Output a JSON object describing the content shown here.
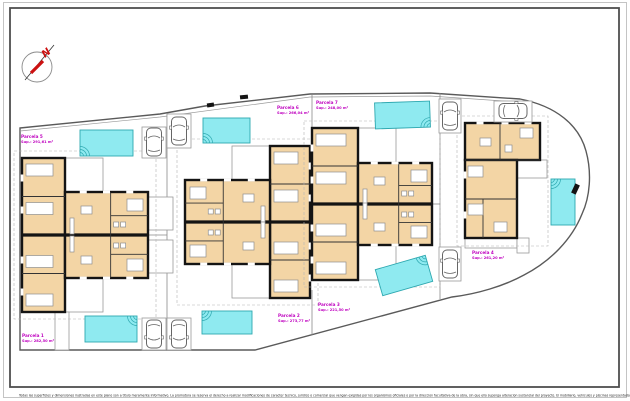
{
  "document": {
    "type": "architectural-site-plan"
  },
  "colors": {
    "room": "#f3d5a5",
    "wall": "#141414",
    "pool_fill": "#8feaf0",
    "pool_edge": "#2ea8b0",
    "label": "#bf00bf",
    "north_red": "#cc1111",
    "boundary": "#5a5a5a",
    "thin_line": "#8a8a8a",
    "frame_outer": "#c4c4c4",
    "frame_inner": "#4f4f4f",
    "furniture": "#8f8f8f"
  },
  "north": {
    "label": "N"
  },
  "parcels": [
    {
      "id": 1,
      "name": "Parcela 1",
      "sup": "Sup.: 282,50 m²",
      "label_x": 22,
      "label_y": 333
    },
    {
      "id": 2,
      "name": "Parcela 2",
      "sup": "Sup.: 273,77 m²",
      "label_x": 278,
      "label_y": 313
    },
    {
      "id": 3,
      "name": "Parcela 3",
      "sup": "Sup.: 221,50 m²",
      "label_x": 318,
      "label_y": 302
    },
    {
      "id": 4,
      "name": "Parcela 4",
      "sup": "Sup.: 261,20 m²",
      "label_x": 472,
      "label_y": 250
    },
    {
      "id": 5,
      "name": "Parcela 5",
      "sup": "Sup.: 291,61 m²",
      "label_x": 21,
      "label_y": 134
    },
    {
      "id": 6,
      "name": "Parcela 6",
      "sup": "Sup.: 266,04 m²",
      "label_x": 277,
      "label_y": 105
    },
    {
      "id": 7,
      "name": "Parcela 7",
      "sup": "Sup.: 248,00 m²",
      "label_x": 316,
      "label_y": 100
    }
  ],
  "site": {
    "boundary": "M20,128 L160,114 L205,106 L310,94 L430,93 L520,99 C556,106 579,125 586,151 C592,173 590,197 582,214 C572,239 551,261 524,275 C504,286 477,294 452,297 L255,350 L20,350 Z",
    "boundary_inner": "M20,131 L160,117 L310,97 L430,96 L518,102",
    "division_lines": [
      [
        167,
        113,
        167,
        350
      ],
      [
        312,
        95,
        312,
        160
      ],
      [
        312,
        290,
        312,
        335
      ],
      [
        440,
        93,
        440,
        299
      ],
      [
        148,
        235,
        167,
        235
      ],
      [
        432,
        204,
        440,
        204
      ],
      [
        310,
        222,
        312,
        222
      ]
    ],
    "terraces": [
      [
        65,
        158,
        38,
        34
      ],
      [
        65,
        278,
        38,
        34
      ],
      [
        148,
        197,
        25,
        33
      ],
      [
        148,
        240,
        25,
        33
      ],
      [
        232,
        146,
        38,
        34
      ],
      [
        232,
        264,
        38,
        34
      ],
      [
        358,
        128,
        38,
        35
      ],
      [
        358,
        245,
        38,
        35
      ],
      [
        517,
        160,
        30,
        18
      ],
      [
        465,
        238,
        52,
        10
      ],
      [
        517,
        238,
        12,
        15
      ],
      [
        55,
        312,
        14,
        38
      ]
    ],
    "gates": [
      [
        240,
        95,
        8,
        4,
        -6
      ],
      [
        573,
        184,
        5,
        10,
        25
      ],
      [
        207,
        103,
        7,
        4,
        -8
      ]
    ]
  },
  "pools": [
    {
      "x": 80,
      "y": 130,
      "w": 53,
      "h": 26,
      "rot": 0,
      "ripple": "bl"
    },
    {
      "x": 203,
      "y": 118,
      "w": 47,
      "h": 25,
      "rot": 0,
      "ripple": "bl"
    },
    {
      "x": 375,
      "y": 102,
      "w": 55,
      "h": 26,
      "rot": -2,
      "ripple": "br"
    },
    {
      "x": 85,
      "y": 316,
      "w": 52,
      "h": 26,
      "rot": 0,
      "ripple": "tr"
    },
    {
      "x": 202,
      "y": 311,
      "w": 50,
      "h": 23,
      "rot": 0,
      "ripple": "tl"
    },
    {
      "x": 378,
      "y": 262,
      "w": 52,
      "h": 27,
      "rot": -16,
      "ripple": "tr"
    },
    {
      "x": 551,
      "y": 179,
      "w": 24,
      "h": 46,
      "rot": 0,
      "ripple": "tl"
    }
  ],
  "parking_bays": [
    [
      142,
      127,
      24,
      31
    ],
    [
      167,
      114,
      24,
      34
    ],
    [
      142,
      318,
      24,
      32
    ],
    [
      167,
      318,
      24,
      32
    ],
    [
      439,
      99,
      22,
      34
    ],
    [
      439,
      247,
      22,
      34
    ],
    [
      494,
      101,
      38,
      21
    ]
  ],
  "cars": [
    {
      "x": 154,
      "y": 142,
      "rot": 0
    },
    {
      "x": 179,
      "y": 131,
      "rot": 0
    },
    {
      "x": 154,
      "y": 334,
      "rot": 180
    },
    {
      "x": 179,
      "y": 334,
      "rot": 180
    },
    {
      "x": 450,
      "y": 116,
      "rot": 0
    },
    {
      "x": 450,
      "y": 264,
      "rot": 0
    },
    {
      "x": 513,
      "y": 111,
      "rot": 90
    }
  ],
  "buildings": {
    "duplexes": [
      {
        "wing": [
          22,
          158,
          43,
          154
        ],
        "central": [
          65,
          192,
          83,
          86
        ],
        "party": 235,
        "side": "left"
      },
      {
        "wing": [
          270,
          146,
          40,
          152
        ],
        "central": [
          185,
          180,
          85,
          84
        ],
        "party": 222,
        "side": "right"
      },
      {
        "wing": [
          312,
          128,
          46,
          152
        ],
        "central": [
          358,
          163,
          74,
          82
        ],
        "party": 204,
        "side": "left"
      }
    ],
    "house": {
      "bars": [
        [
          465,
          123,
          75,
          37
        ],
        [
          465,
          160,
          52,
          78
        ]
      ],
      "lines": [
        [
          500,
          123,
          500,
          160
        ],
        [
          465,
          160,
          540,
          160
        ],
        [
          465,
          199,
          517,
          199
        ],
        [
          483,
          199,
          483,
          238
        ]
      ],
      "furniture": [
        [
          468,
          166,
          15,
          11
        ],
        [
          468,
          204,
          15,
          11
        ],
        [
          520,
          128,
          13,
          10
        ],
        [
          480,
          138,
          11,
          8
        ],
        [
          505,
          145,
          7,
          7
        ],
        [
          494,
          222,
          13,
          10
        ]
      ]
    }
  },
  "footer": {
    "text": "Todas las superficies y dimensiones ilustradas en este plano son a titulo meramente informativo. La promotora se reserva el derecho a realizar modificaciones de caracter tecnico, juridico o comercial que vengan exigidas por los organismos oficiales o por la direccion facultativa de la obra, sin que ello suponga alteracion sustancial del proyecto. El mobiliario, vehiculos y piscinas representados son meramente orientativos."
  }
}
